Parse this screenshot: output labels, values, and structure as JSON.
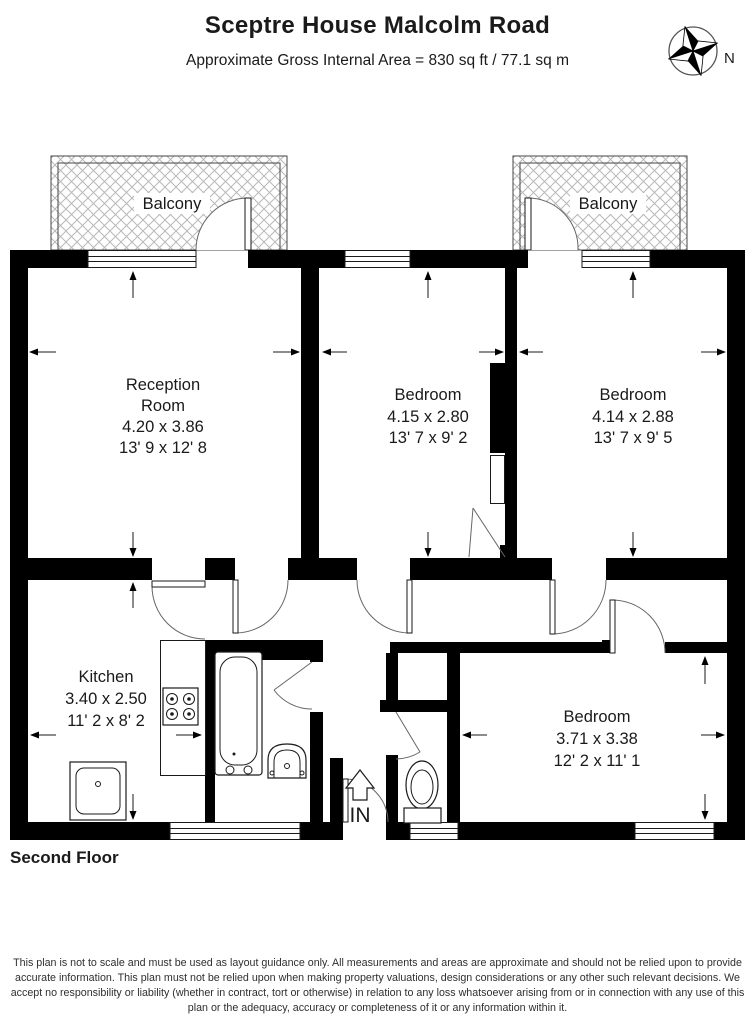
{
  "header": {
    "title": "Sceptre House Malcolm Road",
    "subtitle": "Approximate Gross Internal Area = 830 sq ft / 77.1 sq m"
  },
  "compass": {
    "north_label": "N"
  },
  "plan": {
    "balcony_left": {
      "label": "Balcony"
    },
    "balcony_right": {
      "label": "Balcony"
    },
    "rooms": {
      "reception": {
        "name_line1": "Reception",
        "name_line2": "Room",
        "metric": "4.20 x 3.86",
        "imperial": "13' 9 x 12' 8"
      },
      "bedroom1": {
        "name": "Bedroom",
        "metric": "4.15 x 2.80",
        "imperial": "13' 7 x 9' 2"
      },
      "bedroom2": {
        "name": "Bedroom",
        "metric": "4.14 x 2.88",
        "imperial": "13' 7 x 9' 5"
      },
      "kitchen": {
        "name": "Kitchen",
        "metric": "3.40 x 2.50",
        "imperial": "11' 2 x 8' 2"
      },
      "bedroom3": {
        "name": "Bedroom",
        "metric": "3.71 x 3.38",
        "imperial": "12' 2 x 11' 1"
      }
    },
    "entrance": {
      "label": "IN"
    }
  },
  "floor_label": "Second Floor",
  "disclaimer": "This plan is not to scale and must be used as layout guidance only. All measurements and areas are approximate and should not be relied upon to provide accurate information. This plan must not be relied upon when making property valuations, design considerations or any other such relevant decisions. We accept no responsibility or liability (whether in contract, tort or otherwise) in relation to any loss whatsoever arising from or in connection with any use of this plan or the adequacy, accuracy or completeness of it or any information within it.",
  "colors": {
    "wall": "#000000",
    "hatch_line": "#b8b8b8",
    "text": "#1a1a1a",
    "disclaimer_text": "#2f2f2f"
  }
}
